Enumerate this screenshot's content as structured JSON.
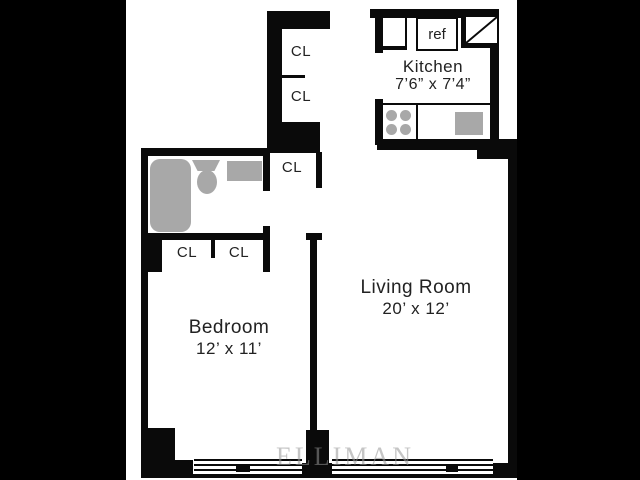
{
  "colors": {
    "canvas_bg": "#000000",
    "plan_bg": "#ffffff",
    "wall": "#0a0a0a",
    "fixture": "#a8a8a8",
    "text": "#222222"
  },
  "rooms": {
    "kitchen": {
      "name": "Kitchen",
      "dims": "7’6” x 7’4”"
    },
    "living_room": {
      "name": "Living Room",
      "dims": "20’ x 12’"
    },
    "bedroom": {
      "name": "Bedroom",
      "dims": "12’ x 11’"
    }
  },
  "closets": {
    "upper_hall_1": "CL",
    "upper_hall_2": "CL",
    "hall": "CL",
    "bedroom_left": "CL",
    "bedroom_right": "CL"
  },
  "appliances": {
    "refrigerator": "ref"
  },
  "watermark": "ELLIMAN"
}
